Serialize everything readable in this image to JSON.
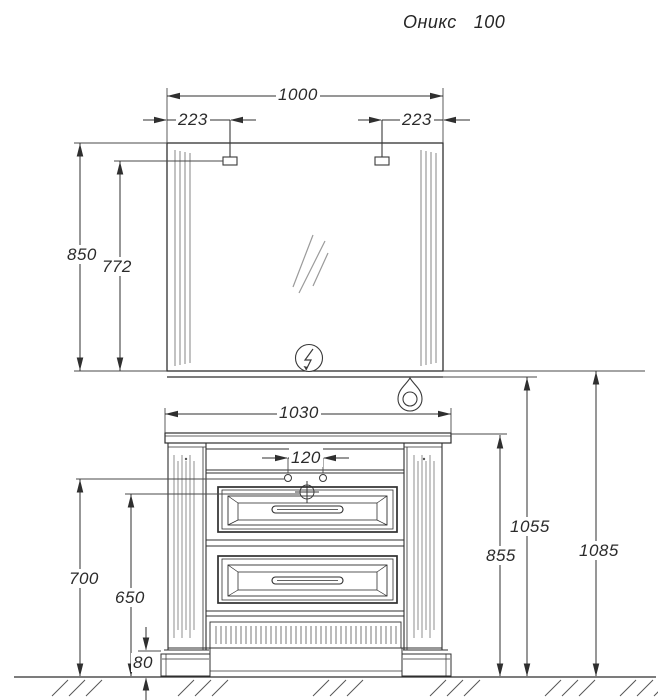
{
  "title": {
    "name": "Оникс",
    "model": "100"
  },
  "dims": {
    "mirror_width": "1000",
    "lamp_offset_left": "223",
    "lamp_offset_right": "223",
    "mirror_height": "850",
    "lamp_height_on_mirror": "772",
    "cabinet_width": "1030",
    "faucet_hole_spacing": "120",
    "faucet_line_height": "700",
    "drain_line_height": "650",
    "plinth_height": "80",
    "countertop_height": "855",
    "mirror_bottom_height": "1055",
    "mirror_frame_height": "1085"
  },
  "icons": {
    "power_outlet": "lightning-circle-icon",
    "water_drop": "drop-pendant-icon"
  },
  "colors": {
    "line": "#2f2f2f",
    "detail": "#8f8f8f"
  }
}
